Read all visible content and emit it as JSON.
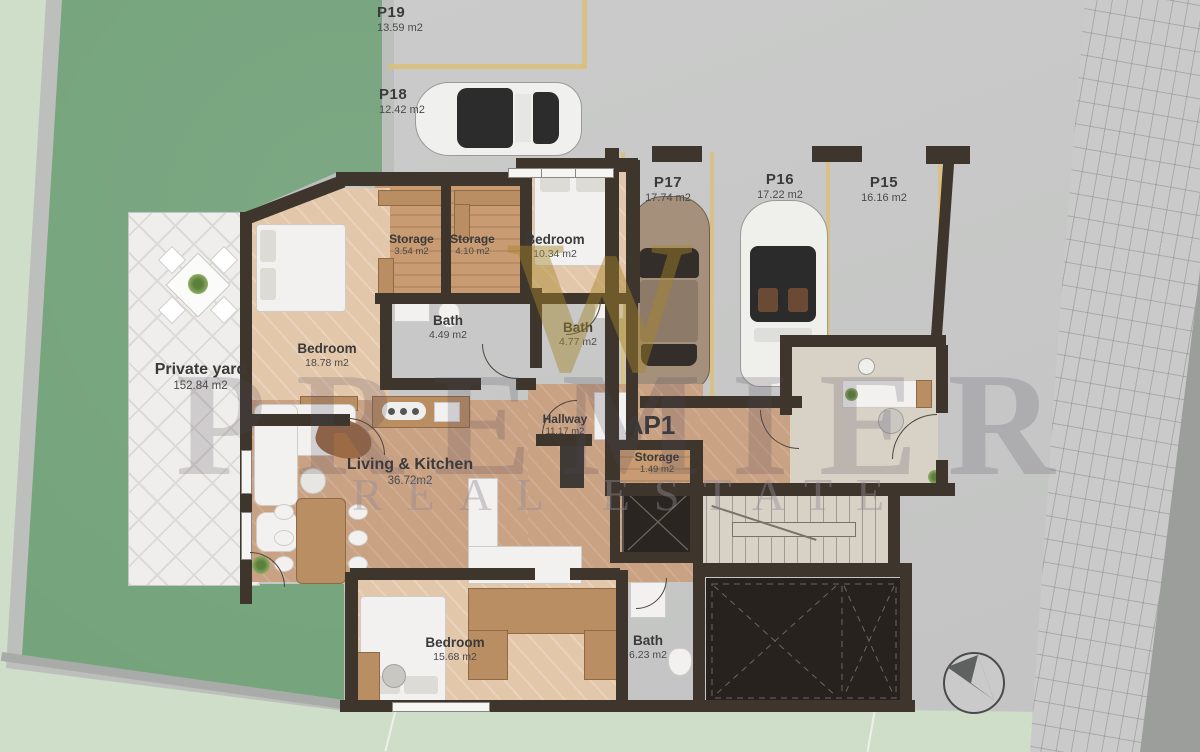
{
  "plan": {
    "apartment_label": "AP1",
    "watermark": {
      "monogram": "W",
      "line1": "PREMIER",
      "line2": "REAL ESTATE"
    },
    "parking_spots": [
      {
        "id": "P19",
        "area": "13.59 m2"
      },
      {
        "id": "P18",
        "area": "12.42 m2"
      },
      {
        "id": "P17",
        "area": "17.74 m2"
      },
      {
        "id": "P16",
        "area": "17.22 m2"
      },
      {
        "id": "P15",
        "area": "16.16 m2"
      }
    ],
    "rooms": [
      {
        "name": "Storage",
        "area": "3.54 m2"
      },
      {
        "name": "Storage",
        "area": "4.10 m2"
      },
      {
        "name": "Bedroom",
        "area": "10.34 m2"
      },
      {
        "name": "Bath",
        "area": "4.49 m2"
      },
      {
        "name": "Bath",
        "area": "4.77 m2"
      },
      {
        "name": "Bedroom",
        "area": "18.78 m2"
      },
      {
        "name": "Private yard",
        "area": "152.84 m2"
      },
      {
        "name": "Living & Kitchen",
        "area": "36.72m2"
      },
      {
        "name": "Hallway",
        "area": "11.17 m2"
      },
      {
        "name": "Storage",
        "area": "1.49 m2"
      },
      {
        "name": "Bedroom",
        "area": "15.68 m2"
      },
      {
        "name": "Bath",
        "area": "6.23 m2"
      }
    ],
    "colors": {
      "wall": "#3e362d",
      "grass": "#74a37b",
      "pale_green": "#cfdec8",
      "concrete": "#c6c7c6",
      "wood_floor": "#c9a183",
      "bedroom_floor": "#e3c7aa",
      "bath_tile": "#dbd9d7",
      "travertine": "#d8d1c5",
      "parking_line": "#d9c078",
      "dark_room": "#27221d",
      "patio": "#efeeec"
    }
  }
}
